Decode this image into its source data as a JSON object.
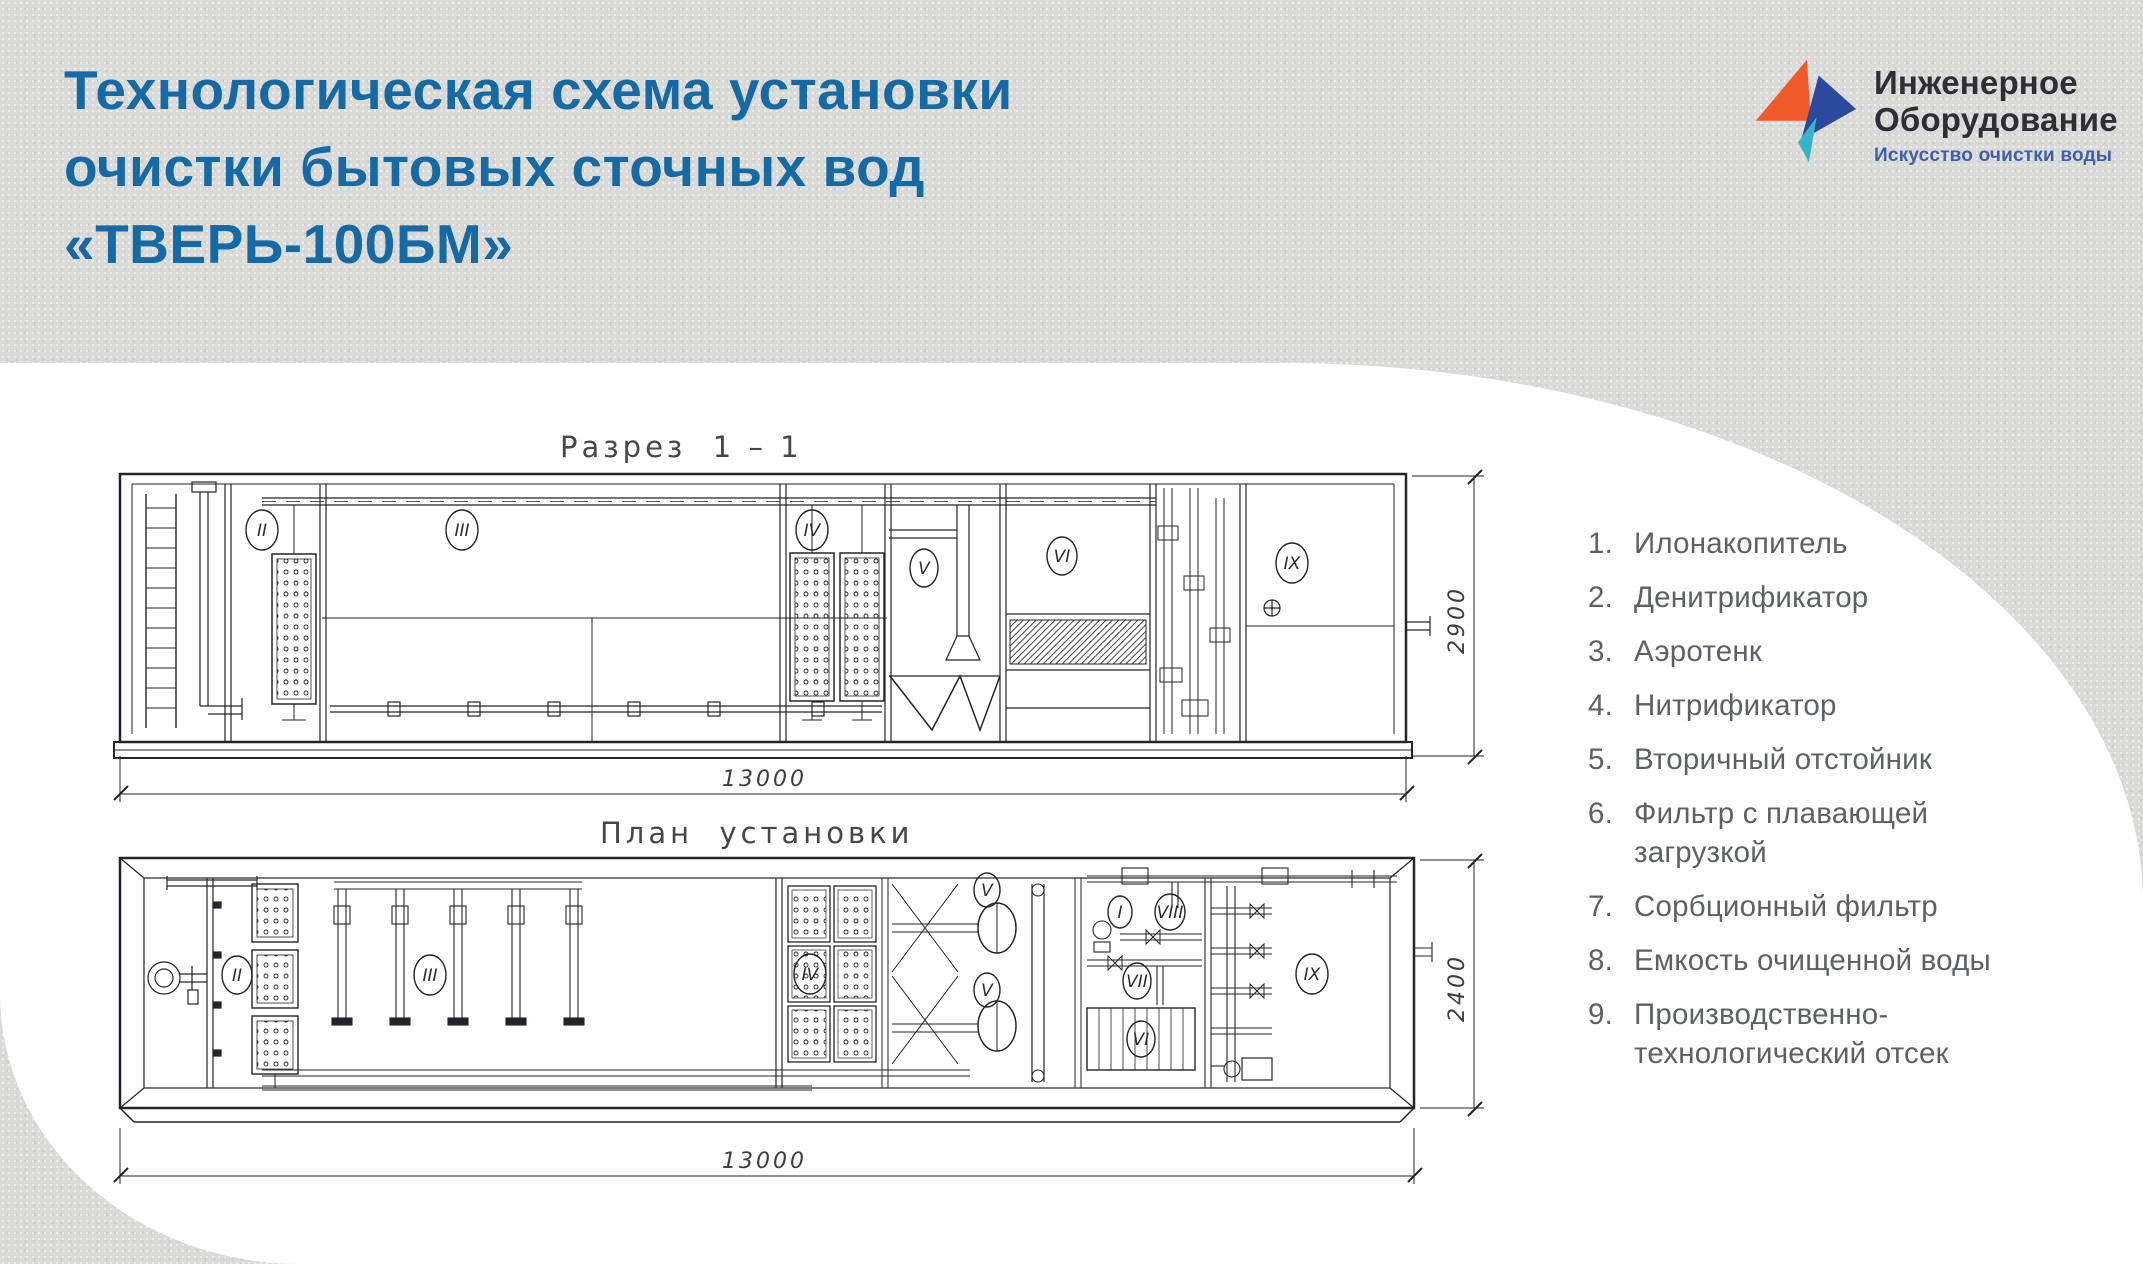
{
  "page": {
    "background": "#dadad8",
    "panel": "#ffffff"
  },
  "header": {
    "title_lines": [
      "Технологическая схема установки",
      "очистки бытовых сточных вод",
      "«ТВЕРЬ-100БМ»"
    ],
    "title_color": "#1569a5",
    "logo": {
      "name_line1": "Инженерное",
      "name_line2": "Оборудование",
      "tagline": "Искусство очистки воды",
      "orange": "#f05a28",
      "blue": "#2b4a9e",
      "teal": "#35b5c8",
      "text_color": "#2e2e35",
      "tagline_color": "#3e5fae"
    }
  },
  "drawings": {
    "line_color": "#23232b",
    "section": {
      "title": "Разрез  1 – 1",
      "width_dim": "13000",
      "height_dim": "2900",
      "numerals": [
        "II",
        "III",
        "IV",
        "V",
        "VI",
        "IX"
      ]
    },
    "plan": {
      "title": "План  установки",
      "width_dim": "13000",
      "height_dim": "2400",
      "numerals": [
        "II",
        "III",
        "IV",
        "V",
        "V",
        "I",
        "VIII",
        "VII",
        "VI",
        "IX"
      ]
    }
  },
  "legend": {
    "items": [
      {
        "num": "1.",
        "label": "Илонакопитель"
      },
      {
        "num": "2.",
        "label": "Денитрификатор"
      },
      {
        "num": "3.",
        "label": "Аэротенк"
      },
      {
        "num": "4.",
        "label": "Нитрификатор"
      },
      {
        "num": "5.",
        "label": "Вторичный отстойник"
      },
      {
        "num": "6.",
        "label": "Фильтр с плавающей\nзагрузкой"
      },
      {
        "num": "7.",
        "label": "Сорбционный фильтр"
      },
      {
        "num": "8.",
        "label": "Емкость очищенной воды"
      },
      {
        "num": "9.",
        "label": "Производственно-\nтехнологический отсек"
      }
    ]
  }
}
